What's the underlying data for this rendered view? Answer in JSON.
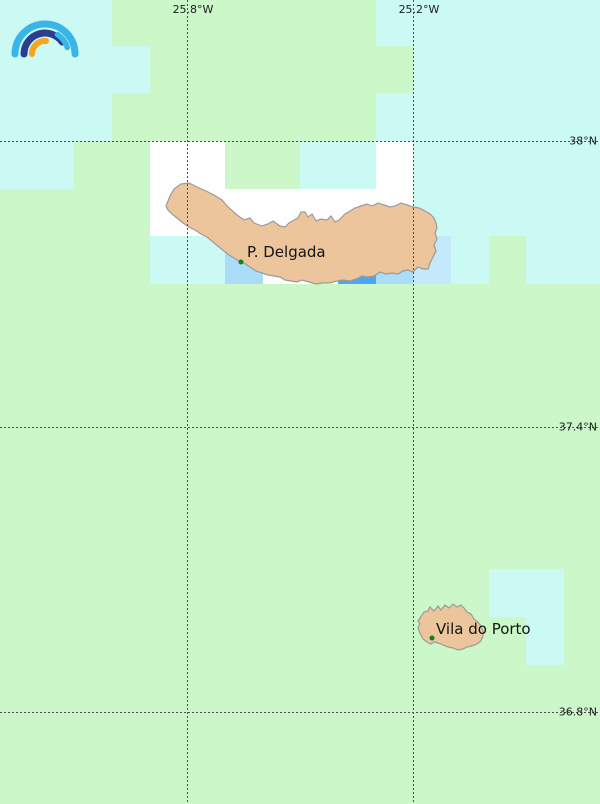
{
  "map": {
    "width": 600,
    "height": 804,
    "colors": {
      "background_green": "#ccf7c8",
      "cyan": "#cbfaf5",
      "white": "#fefefe",
      "light_blue": "#abdcf8",
      "pale_blue": "#c3e9fa",
      "medium_blue": "#4da6f2",
      "island_fill": "#ecc59d",
      "island_stroke": "#9b9b99",
      "gridline": "#4d4d4d",
      "label_text": "#1c1c1c",
      "city_dot": "#1e7a1e",
      "logo_light_blue": "#3ab5ea",
      "logo_dark_blue": "#2b3f8e",
      "logo_orange": "#f7a41f"
    },
    "gridlines": {
      "vertical": [
        {
          "x": 187,
          "label": "25.8°W"
        },
        {
          "x": 413,
          "label": "25.2°W"
        }
      ],
      "horizontal": [
        {
          "y": 141,
          "label": "38°N"
        },
        {
          "y": 427,
          "label": "37.4°N"
        },
        {
          "y": 712,
          "label": "36.8°N"
        }
      ]
    },
    "raster_cells": {
      "cyan": [
        {
          "x": 0,
          "y": 0,
          "w": 112,
          "h": 141
        },
        {
          "x": 112,
          "y": 46,
          "w": 38,
          "h": 47
        },
        {
          "x": 376,
          "y": 0,
          "w": 37,
          "h": 46
        },
        {
          "x": 413,
          "y": 0,
          "w": 187,
          "h": 236
        },
        {
          "x": 376,
          "y": 93,
          "w": 37,
          "h": 48
        },
        {
          "x": 0,
          "y": 141,
          "w": 74,
          "h": 48
        },
        {
          "x": 300,
          "y": 141,
          "w": 76,
          "h": 48
        },
        {
          "x": 150,
          "y": 236,
          "w": 75,
          "h": 48
        },
        {
          "x": 451,
          "y": 236,
          "w": 38,
          "h": 48
        },
        {
          "x": 526,
          "y": 236,
          "w": 74,
          "h": 48
        },
        {
          "x": 489,
          "y": 569,
          "w": 75,
          "h": 48
        },
        {
          "x": 526,
          "y": 617,
          "w": 38,
          "h": 48
        }
      ],
      "white": [
        {
          "x": 150,
          "y": 141,
          "w": 75,
          "h": 48
        },
        {
          "x": 376,
          "y": 141,
          "w": 37,
          "h": 48
        },
        {
          "x": 150,
          "y": 189,
          "w": 263,
          "h": 47
        },
        {
          "x": 263,
          "y": 236,
          "w": 75,
          "h": 48
        }
      ],
      "light_blue": [
        {
          "x": 225,
          "y": 236,
          "w": 38,
          "h": 48
        },
        {
          "x": 376,
          "y": 236,
          "w": 37,
          "h": 48
        }
      ],
      "pale_blue": [
        {
          "x": 413,
          "y": 236,
          "w": 38,
          "h": 48
        }
      ],
      "medium_blue": [
        {
          "x": 338,
          "y": 236,
          "w": 38,
          "h": 48
        }
      ]
    },
    "cities": [
      {
        "name": "P. Delgada",
        "dot_x": 241,
        "dot_y": 262,
        "label_x": 247,
        "label_y": 245
      },
      {
        "name": "Vila do Porto",
        "dot_x": 432,
        "dot_y": 638,
        "label_x": 436,
        "label_y": 622
      }
    ]
  }
}
